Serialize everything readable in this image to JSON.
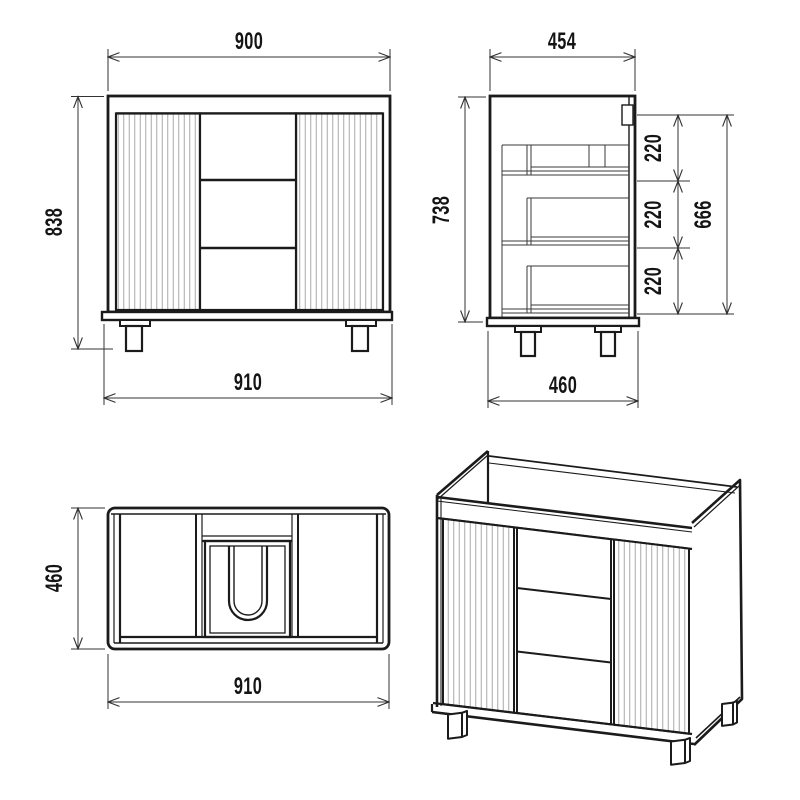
{
  "drawing": {
    "title": "Vanity cabinet technical drawing - four views",
    "background": "#ffffff",
    "line_color": "#1b1b1b",
    "thin_line_color": "#3a3a3a",
    "dim_color": "#333333",
    "flute_color": "#a9a9a9",
    "front_view": {
      "dim_top_width": "900",
      "dim_height": "838",
      "dim_bottom_width": "910"
    },
    "side_view": {
      "dim_top_depth": "454",
      "dim_height": "738",
      "dim_segments": [
        "220",
        "220",
        "220"
      ],
      "dim_segments_total": "666",
      "dim_bottom_depth": "460"
    },
    "top_view": {
      "dim_depth": "460",
      "dim_width": "910"
    }
  }
}
